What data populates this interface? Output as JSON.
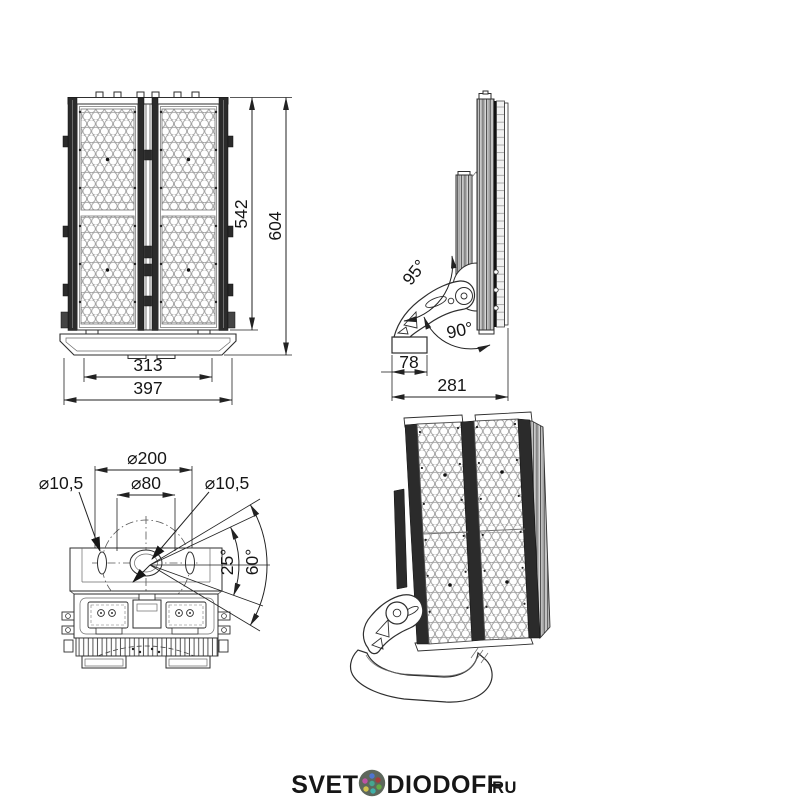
{
  "drawing": {
    "kind": "LED floodlight dimensional drawing",
    "line_color": "#2e2e2e"
  },
  "views": {
    "front": {
      "label": "front-view",
      "dims": {
        "panel_height": "542",
        "total_height": "604",
        "inner_width": "313",
        "total_width": "397"
      }
    },
    "side": {
      "label": "side-view",
      "angles": {
        "upper": "95°",
        "lower": "90°"
      },
      "dims": {
        "base_depth": "78",
        "total_depth": "281"
      }
    },
    "top": {
      "label": "top-view",
      "dims": {
        "bolt_circle": "⌀200",
        "center_hole": "⌀80",
        "left_hole": "⌀10,5",
        "right_hole": "⌀10,5"
      },
      "angles": {
        "inner": "25°",
        "outer": "60°"
      }
    },
    "iso": {
      "label": "isometric-view"
    }
  },
  "logo": {
    "part1": "SVET",
    "part2": "DIODOFF",
    "tld": ".RU",
    "color": "#b3d48c",
    "icon_bg": "#5d675c",
    "dot_colors": [
      "#4f74cf",
      "#a63b3b",
      "#65a844",
      "#3eb0a8",
      "#d1c24d",
      "#bd52a4",
      "#46a58f"
    ]
  }
}
